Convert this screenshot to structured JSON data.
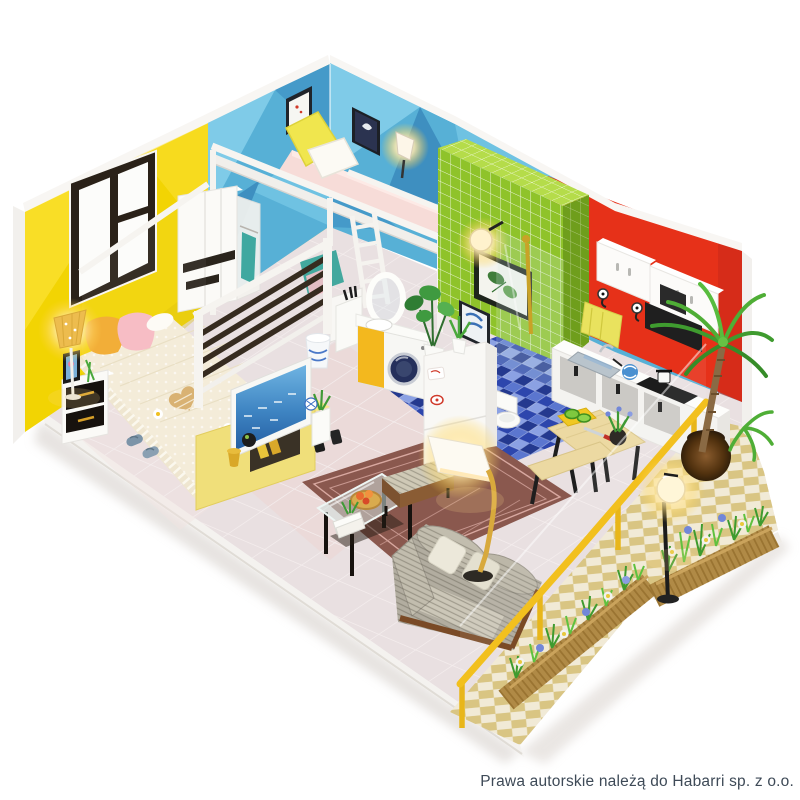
{
  "meta": {
    "type": "product-photo",
    "description": "DIY miniature dollhouse studio apartment roombox shown from above in isometric view on a white background, interior LED lamps glowing"
  },
  "caption": {
    "copyright": "Prawa autorskie należą do Habarri sp. z o.o."
  },
  "palette": {
    "background": "#ffffff",
    "wall_yellow": "#f2d403",
    "wall_blue": "#57b0d6",
    "tile_green": "#8fc32a",
    "tile_green_top": "#b5dc4a",
    "wall_red": "#e63119",
    "floor_tile": "#e9e0e1",
    "bathroom_mosaic": "#2d46ad",
    "terrace_tile": "#f1ead6",
    "terrace_diamond": "#d9c583",
    "railing_yellow": "#f2c01e",
    "rug_brown": "#8a584e",
    "sofa_gray": "#b2ada0",
    "wood_dark": "#362b1f",
    "glow_warm": "#ffeaae",
    "text_color": "#3e4a57"
  },
  "scene": {
    "rooms": [
      "bedroom",
      "loft bedroom",
      "living room",
      "bathroom",
      "kitchen",
      "dining nook",
      "terrace"
    ],
    "objects": [
      "double bed with crochet blanket",
      "loft bed with ladder",
      "wardrobe",
      "dark slat partition",
      "nightstand",
      "glowing floor lamp",
      "window",
      "picture frames",
      "TV on yellow TV stand",
      "rug",
      "glass coffee table",
      "ottoman",
      "striped sofa",
      "arched reading lamp",
      "washing machine",
      "round mirror",
      "laundry basket",
      "refrigerator",
      "potted plants",
      "green tiled bathroom wall",
      "shower enclosure",
      "toilet",
      "blue mosaic bathroom floor",
      "red kitchen wall",
      "white kitchen cabinets",
      "black range hood",
      "kitchen counter with sink and hob",
      "yellow hand towel",
      "dining table with benches",
      "yellow terrace railing",
      "diamond tiled terrace",
      "flower planter boxes",
      "glowing terrace lamp",
      "potted palm tree"
    ]
  }
}
